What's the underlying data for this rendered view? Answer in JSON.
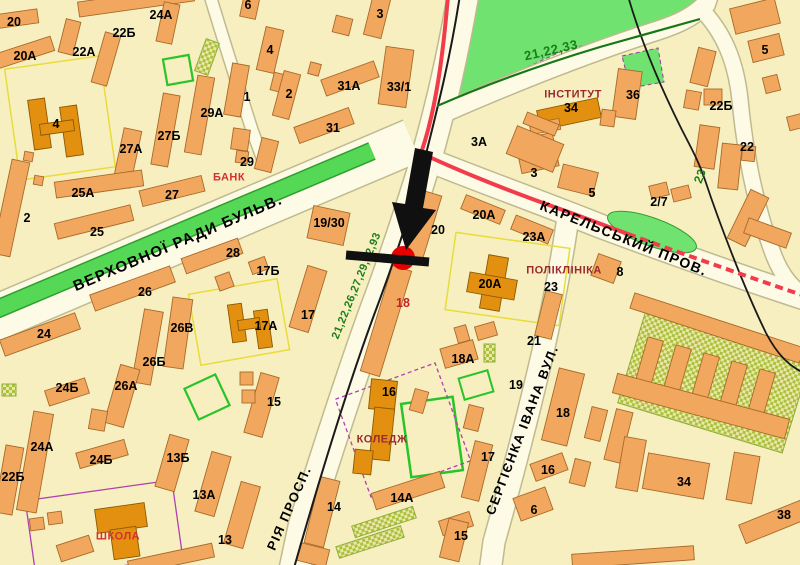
{
  "map": {
    "marker": {
      "dot_color": "#E60000",
      "arrow_color": "#101010",
      "crossbar_color": "#101010"
    },
    "colors": {
      "block": "#F7EFC0",
      "road_fill": "#FDFAE6",
      "road_casing": "#BFBA90",
      "building": "#F2A75F",
      "building_outline": "#A86A28",
      "public_building": "#E39010",
      "public_building_outline": "#8A5A00",
      "park_green": "#70E270",
      "median_green": "#55D855",
      "route_red": "#F23B4B",
      "route_black": "#1A1A1A",
      "route_green_line": "#157815"
    },
    "labels": [
      {
        "t": "ВЕРХОВНОЇ РАДИ БУЛЬВ.",
        "x": 178,
        "y": 243,
        "r": -23,
        "k": "st",
        "s": 15
      },
      {
        "t": "КАРЕЛЬСЬКИЙ ПРОВ.",
        "x": 624,
        "y": 238,
        "r": 22,
        "k": "st"
      },
      {
        "t": "СЕРГІЄНКА ІВАНА ВУЛ.",
        "x": 522,
        "y": 430,
        "r": -69,
        "k": "st",
        "s": 13
      },
      {
        "t": "РІЯ ПРОСП.",
        "x": 289,
        "y": 508,
        "r": -66,
        "k": "st",
        "s": 13
      },
      {
        "t": "21,22,33",
        "x": 551,
        "y": 50,
        "r": -13,
        "k": "rt",
        "s": 13
      },
      {
        "t": "23",
        "x": 700,
        "y": 176,
        "r": -70,
        "k": "rt"
      },
      {
        "t": "21,22,26,27,29,92,93",
        "x": 357,
        "y": 286,
        "r": -68,
        "k": "rt",
        "s": 11
      },
      {
        "t": "БАНК",
        "x": 229,
        "y": 178,
        "k": "poir"
      },
      {
        "t": "ШКОЛА",
        "x": 118,
        "y": 537,
        "k": "poir"
      },
      {
        "t": "ІНСТИТУТ",
        "x": 573,
        "y": 95,
        "k": "poi"
      },
      {
        "t": "ПОЛІКЛІНІКА",
        "x": 564,
        "y": 271,
        "k": "poi"
      },
      {
        "t": "КОЛЕДЖ",
        "x": 382,
        "y": 440,
        "k": "poi"
      },
      {
        "t": "18",
        "x": 403,
        "y": 303,
        "k": "numr"
      },
      {
        "t": "20",
        "x": 14,
        "y": 22,
        "k": "num"
      },
      {
        "t": "24А",
        "x": 161,
        "y": 15,
        "k": "num"
      },
      {
        "t": "22Б",
        "x": 124,
        "y": 33,
        "k": "num"
      },
      {
        "t": "6",
        "x": 248,
        "y": 5,
        "k": "num"
      },
      {
        "t": "22А",
        "x": 84,
        "y": 52,
        "k": "num"
      },
      {
        "t": "20А",
        "x": 25,
        "y": 56,
        "k": "num"
      },
      {
        "t": "3",
        "x": 380,
        "y": 14,
        "k": "num"
      },
      {
        "t": "4",
        "x": 270,
        "y": 50,
        "k": "num"
      },
      {
        "t": "31А",
        "x": 349,
        "y": 86,
        "k": "num"
      },
      {
        "t": "33/1",
        "x": 399,
        "y": 87,
        "k": "num"
      },
      {
        "t": "2",
        "x": 289,
        "y": 94,
        "k": "num"
      },
      {
        "t": "31",
        "x": 333,
        "y": 128,
        "k": "num"
      },
      {
        "t": "4",
        "x": 56,
        "y": 124,
        "k": "num"
      },
      {
        "t": "29А",
        "x": 212,
        "y": 113,
        "k": "num"
      },
      {
        "t": "27Б",
        "x": 169,
        "y": 136,
        "k": "num"
      },
      {
        "t": "27А",
        "x": 131,
        "y": 149,
        "k": "num"
      },
      {
        "t": "1",
        "x": 247,
        "y": 97,
        "k": "num"
      },
      {
        "t": "29",
        "x": 247,
        "y": 162,
        "k": "num"
      },
      {
        "t": "25А",
        "x": 83,
        "y": 193,
        "k": "num"
      },
      {
        "t": "27",
        "x": 172,
        "y": 195,
        "k": "num"
      },
      {
        "t": "25",
        "x": 97,
        "y": 232,
        "k": "num"
      },
      {
        "t": "2",
        "x": 27,
        "y": 218,
        "k": "num"
      },
      {
        "t": "3А",
        "x": 479,
        "y": 142,
        "k": "num"
      },
      {
        "t": "34",
        "x": 571,
        "y": 108,
        "k": "num"
      },
      {
        "t": "36",
        "x": 633,
        "y": 95,
        "k": "num"
      },
      {
        "t": "22Б",
        "x": 721,
        "y": 106,
        "k": "num"
      },
      {
        "t": "5",
        "x": 765,
        "y": 50,
        "k": "num"
      },
      {
        "t": "22",
        "x": 747,
        "y": 147,
        "k": "num"
      },
      {
        "t": "5",
        "x": 592,
        "y": 193,
        "k": "num"
      },
      {
        "t": "2/7",
        "x": 659,
        "y": 202,
        "k": "num"
      },
      {
        "t": "3",
        "x": 534,
        "y": 173,
        "k": "num"
      },
      {
        "t": "19/30",
        "x": 329,
        "y": 223,
        "k": "num"
      },
      {
        "t": "20",
        "x": 438,
        "y": 230,
        "k": "num"
      },
      {
        "t": "20А",
        "x": 484,
        "y": 215,
        "k": "num"
      },
      {
        "t": "23А",
        "x": 534,
        "y": 237,
        "k": "num"
      },
      {
        "t": "20А",
        "x": 490,
        "y": 284,
        "k": "num"
      },
      {
        "t": "23",
        "x": 551,
        "y": 287,
        "k": "num"
      },
      {
        "t": "8",
        "x": 620,
        "y": 272,
        "k": "num"
      },
      {
        "t": "28",
        "x": 233,
        "y": 253,
        "k": "num"
      },
      {
        "t": "17Б",
        "x": 268,
        "y": 271,
        "k": "num"
      },
      {
        "t": "26",
        "x": 145,
        "y": 292,
        "k": "num"
      },
      {
        "t": "26В",
        "x": 182,
        "y": 328,
        "k": "num"
      },
      {
        "t": "17А",
        "x": 266,
        "y": 326,
        "k": "num"
      },
      {
        "t": "17",
        "x": 308,
        "y": 315,
        "k": "num"
      },
      {
        "t": "26Б",
        "x": 154,
        "y": 362,
        "k": "num"
      },
      {
        "t": "24",
        "x": 44,
        "y": 334,
        "k": "num"
      },
      {
        "t": "26А",
        "x": 126,
        "y": 386,
        "k": "num"
      },
      {
        "t": "24Б",
        "x": 67,
        "y": 388,
        "k": "num"
      },
      {
        "t": "24А",
        "x": 42,
        "y": 447,
        "k": "num"
      },
      {
        "t": "24Б",
        "x": 101,
        "y": 460,
        "k": "num"
      },
      {
        "t": "22Б",
        "x": 13,
        "y": 477,
        "k": "num"
      },
      {
        "t": "13Б",
        "x": 178,
        "y": 458,
        "k": "num"
      },
      {
        "t": "13А",
        "x": 204,
        "y": 495,
        "k": "num"
      },
      {
        "t": "13",
        "x": 225,
        "y": 540,
        "k": "num"
      },
      {
        "t": "15",
        "x": 274,
        "y": 402,
        "k": "num"
      },
      {
        "t": "16",
        "x": 389,
        "y": 392,
        "k": "num"
      },
      {
        "t": "18А",
        "x": 463,
        "y": 359,
        "k": "num"
      },
      {
        "t": "21",
        "x": 534,
        "y": 341,
        "k": "num"
      },
      {
        "t": "19",
        "x": 516,
        "y": 385,
        "k": "num"
      },
      {
        "t": "14А",
        "x": 402,
        "y": 498,
        "k": "num"
      },
      {
        "t": "14",
        "x": 334,
        "y": 507,
        "k": "num"
      },
      {
        "t": "15",
        "x": 461,
        "y": 536,
        "k": "num"
      },
      {
        "t": "17",
        "x": 488,
        "y": 457,
        "k": "num"
      },
      {
        "t": "16",
        "x": 548,
        "y": 470,
        "k": "num"
      },
      {
        "t": "6",
        "x": 534,
        "y": 510,
        "k": "num"
      },
      {
        "t": "18",
        "x": 563,
        "y": 413,
        "k": "num"
      },
      {
        "t": "34",
        "x": 684,
        "y": 482,
        "k": "num"
      },
      {
        "t": "38",
        "x": 784,
        "y": 515,
        "k": "num"
      }
    ]
  }
}
